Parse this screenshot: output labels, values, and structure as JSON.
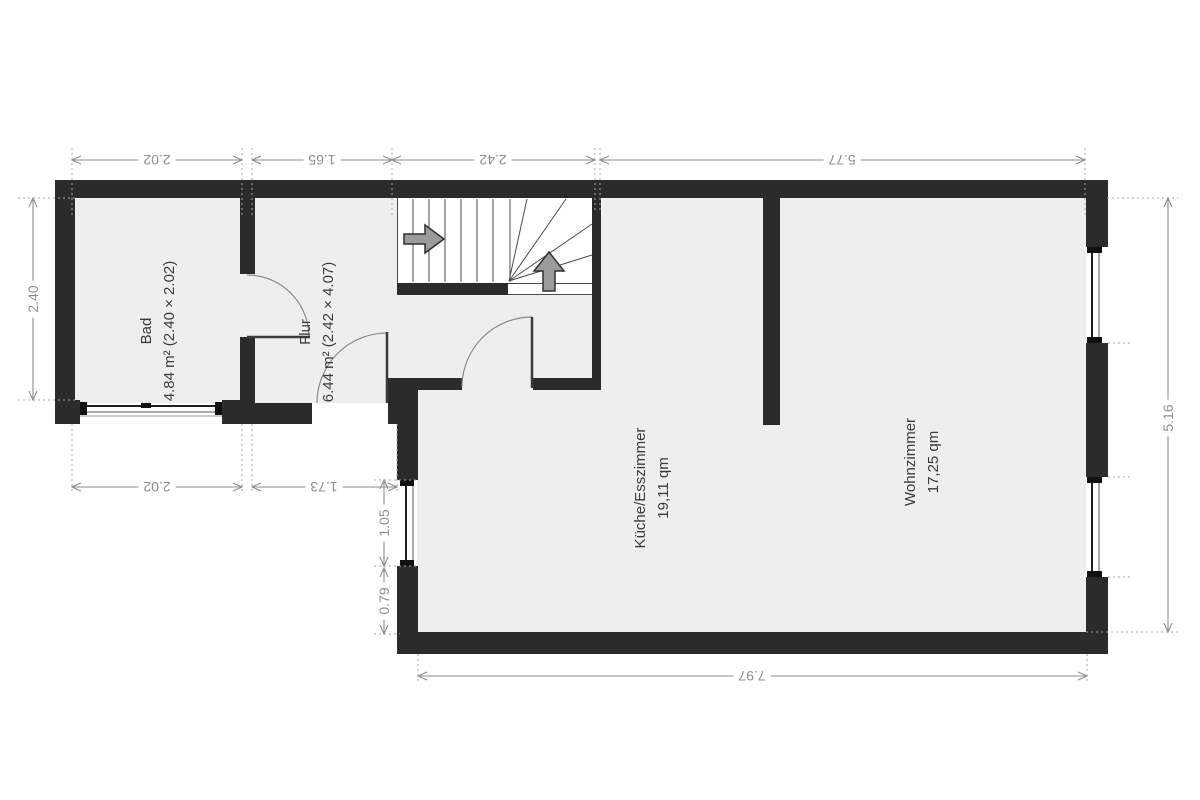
{
  "colors": {
    "wall": "#2b2b2b",
    "floor": "#eeeeef",
    "dimension": "#8e8e8e",
    "label": "#3a3a3a"
  },
  "rooms": {
    "bad": {
      "name": "Bad",
      "area": "4.84 m² (2.40 × 2.02)"
    },
    "flur": {
      "name": "Flur",
      "area": "6.44 m² (2.42 × 4.07)"
    },
    "kueche": {
      "name": "Küche/Esszimmer",
      "area": "19,11 qm"
    },
    "wohnzimmer": {
      "name": "Wohnzimmer",
      "area": "17,25 qm"
    }
  },
  "dimensions": {
    "top_bad": "2.02",
    "top_flur": "1.65",
    "top_stairs": "2.42",
    "top_right": "5.77",
    "left_bad": "2.40",
    "bottom_bad": "2.02",
    "bottom_flur": "1.73",
    "left_window": "1.05",
    "left_lower_wall": "0.79",
    "bottom_main": "7.97",
    "right_main": "5.16"
  },
  "stairs": {
    "direction_icons": [
      "arrow-right",
      "arrow-up"
    ]
  }
}
